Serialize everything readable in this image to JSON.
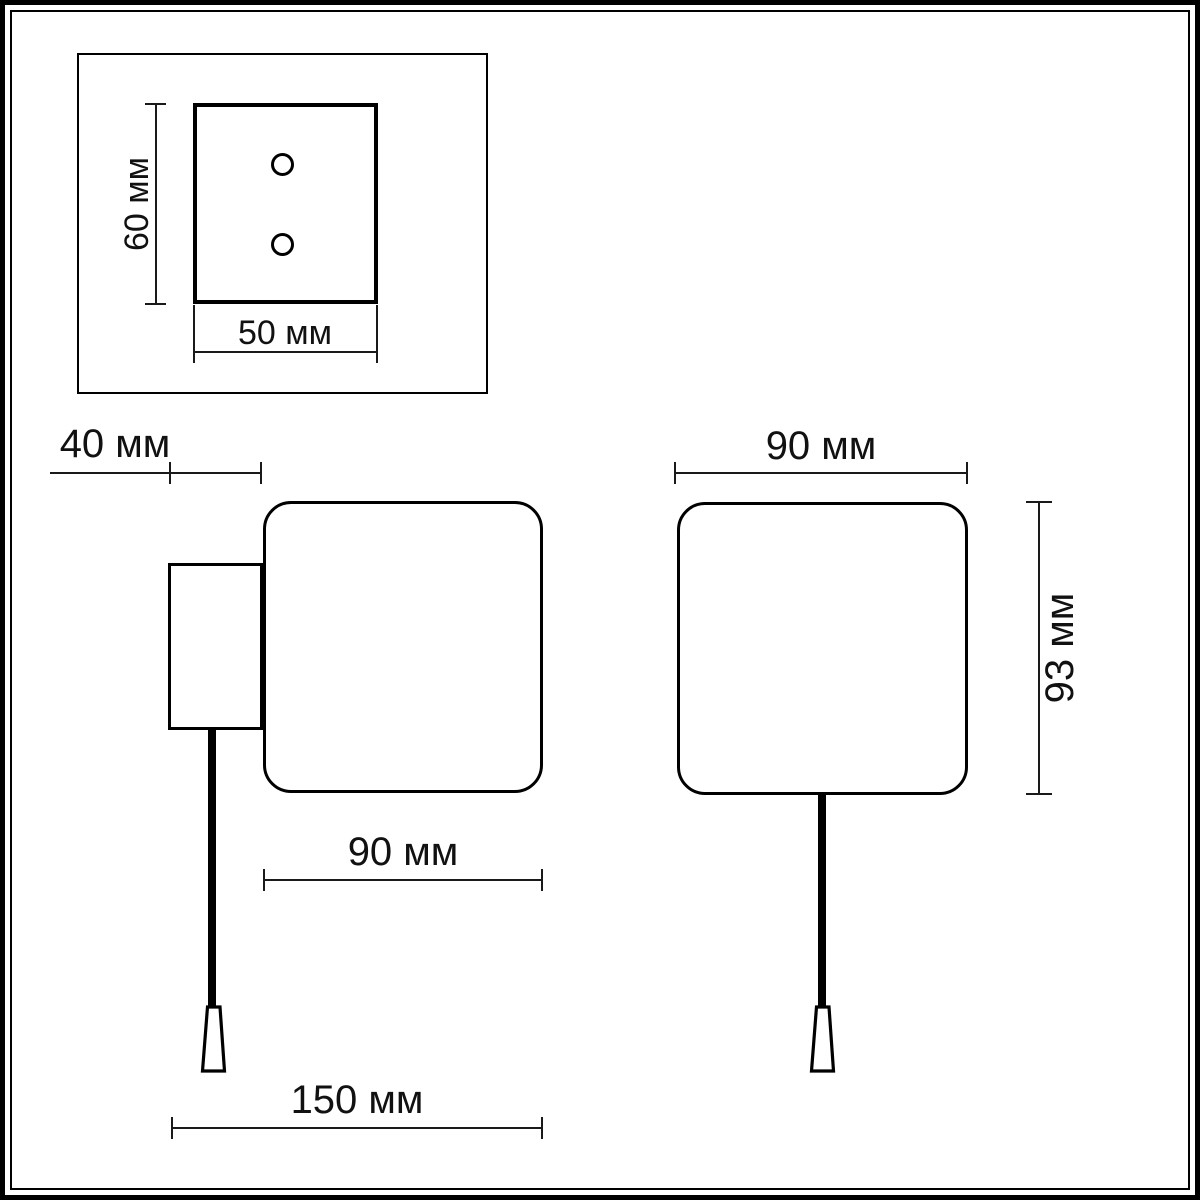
{
  "colors": {
    "background": "#ffffff",
    "line": "#000000"
  },
  "dimensions": {
    "top_view": {
      "height": "60 мм",
      "width": "50 мм"
    },
    "side_view": {
      "bracket_depth": "40 мм",
      "shade_width": "90 мм",
      "overall_width": "150 мм"
    },
    "front_view": {
      "width": "90 мм",
      "height": "93 мм"
    }
  }
}
